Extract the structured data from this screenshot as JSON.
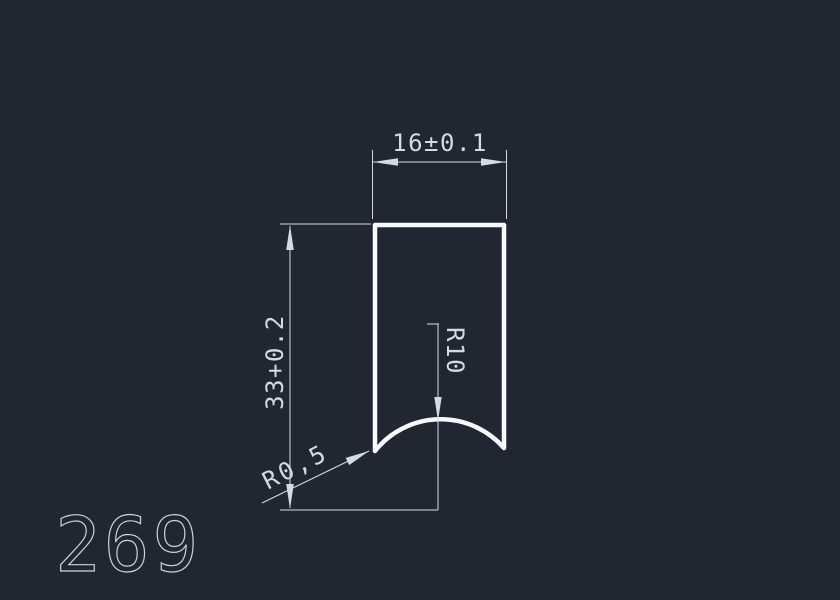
{
  "app": {
    "background_color": "#212633"
  },
  "drawing": {
    "number": "269",
    "colors": {
      "outline": "#f8f9fb",
      "dimension": "#d5dae1",
      "number_stroke": "#cbd1d8"
    },
    "dimensions": {
      "width": {
        "value": "16±0.1"
      },
      "height": {
        "value": "33+0.2"
      },
      "arc_radius": {
        "value": "R10"
      },
      "corner_radius": {
        "value": "R0,5"
      }
    }
  }
}
